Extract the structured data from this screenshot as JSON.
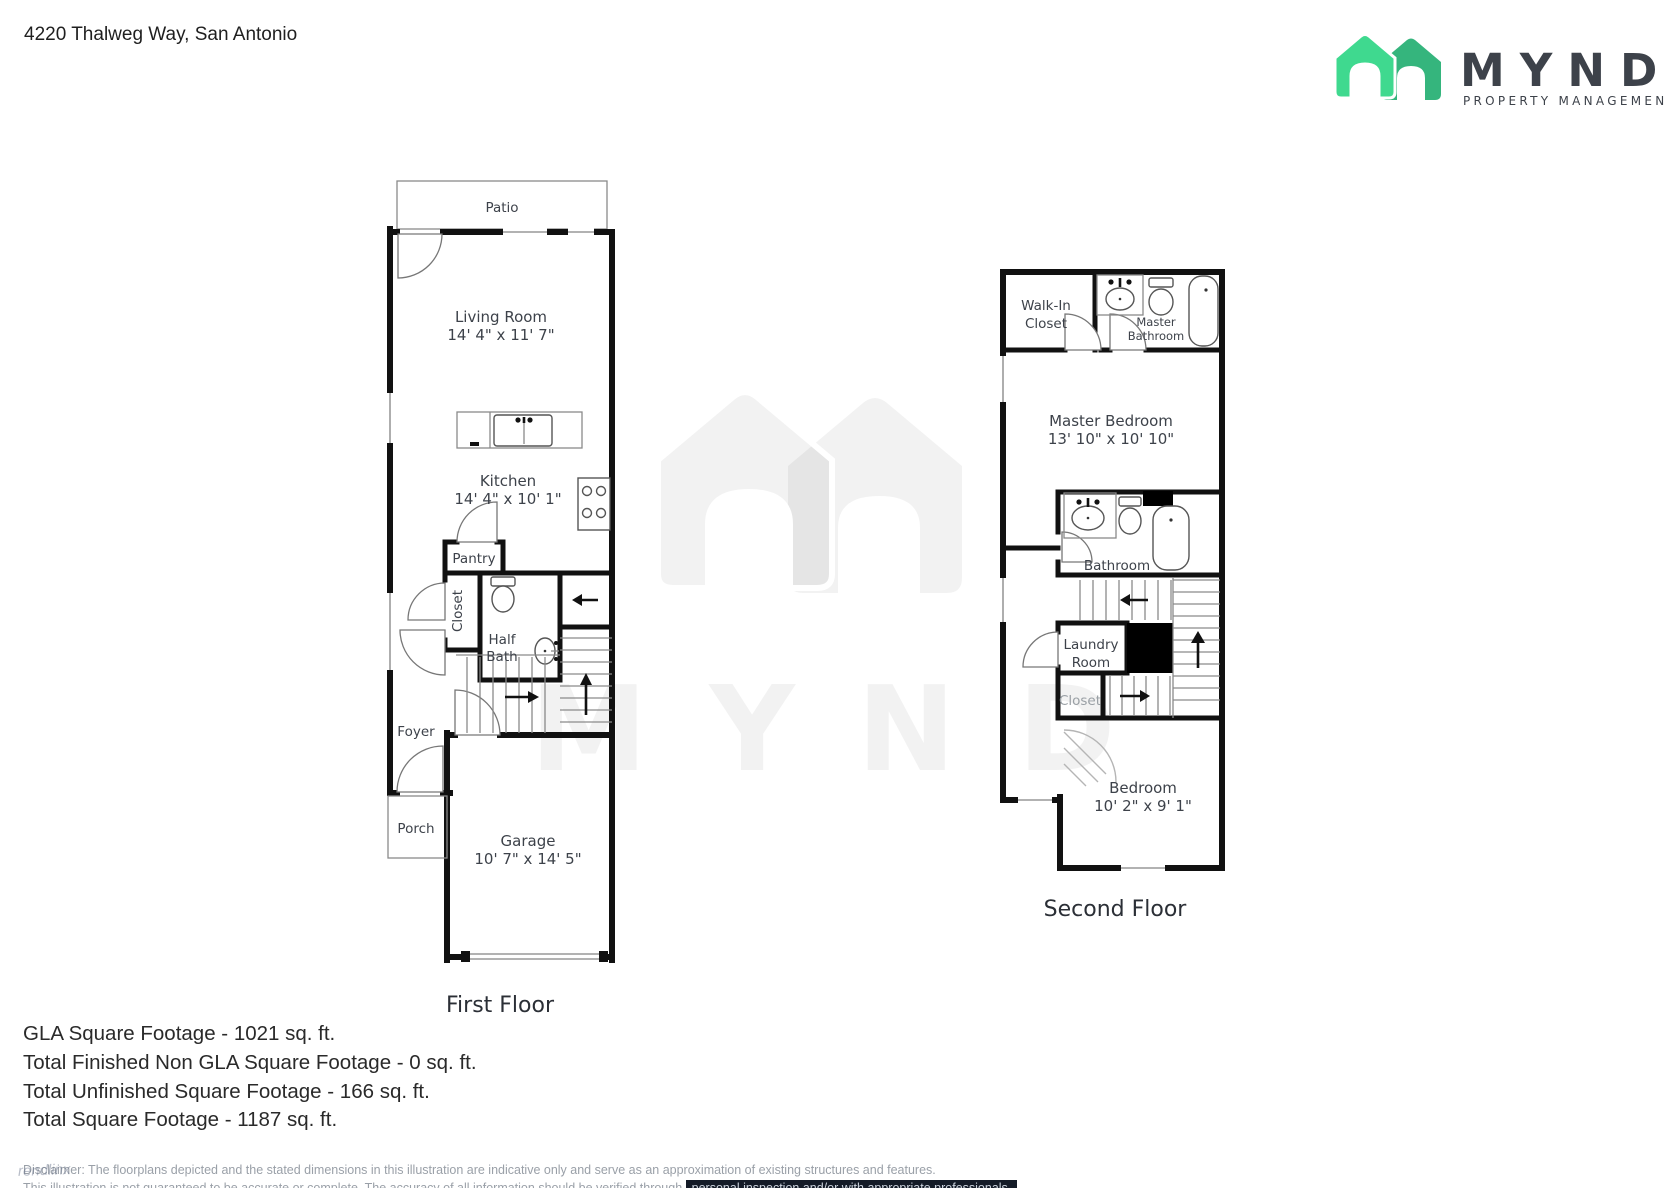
{
  "header": {
    "address": "4220 Thalweg Way, San Antonio",
    "brand": "MYND",
    "tagline": "PROPERTY MANAGEMENT"
  },
  "first_floor": {
    "caption": "First Floor",
    "patio": "Patio",
    "living_room": "Living Room",
    "living_room_dims": "14' 4\" x 11' 7\"",
    "kitchen": "Kitchen",
    "kitchen_dims": "14' 4\" x 10' 1\"",
    "pantry": "Pantry",
    "closet": "Closet",
    "half_bath_1": "Half",
    "half_bath_2": "Bath",
    "foyer": "Foyer",
    "porch": "Porch",
    "garage": "Garage",
    "garage_dims": "10' 7\" x 14' 5\""
  },
  "second_floor": {
    "caption": "Second Floor",
    "walk_in_closet_1": "Walk-In",
    "walk_in_closet_2": "Closet",
    "master_bathroom_1": "Master",
    "master_bathroom_2": "Bathroom",
    "master_bedroom": "Master Bedroom",
    "master_bedroom_dims": "13' 10\" x 10' 10\"",
    "bathroom": "Bathroom",
    "laundry_room_1": "Laundry",
    "laundry_room_2": "Room",
    "closet": "Closet",
    "bedroom": "Bedroom",
    "bedroom_dims": "10' 2\" x 9' 1\""
  },
  "summary": {
    "gla": "GLA Square Footage - 1021 sq. ft.",
    "non_gla": "Total Finished Non GLA Square Footage - 0 sq. ft.",
    "unfinished": "Total Unfinished Square Footage - 166 sq. ft.",
    "total": "Total Square Footage - 1187 sq. ft."
  },
  "disclaimer": {
    "line1": "Disclaimer: The floorplans depicted and the stated dimensions in this illustration are indicative only and serve as an approximation of existing structures and features.",
    "line2_prefix": "This illustration is not guaranteed to be accurate or complete. The accuracy of all information should be verified through ",
    "line2_highlight": "personal inspection and/or with appropriate professionals."
  },
  "watermark": {
    "brand": "MYND",
    "corner": "rendlinx"
  },
  "colors": {
    "logo_green_light": "#3FD98F",
    "logo_green_dark": "#35B57D",
    "logo_navy": "#1B2B57",
    "wall": "#111111",
    "label": "#3D424A"
  }
}
